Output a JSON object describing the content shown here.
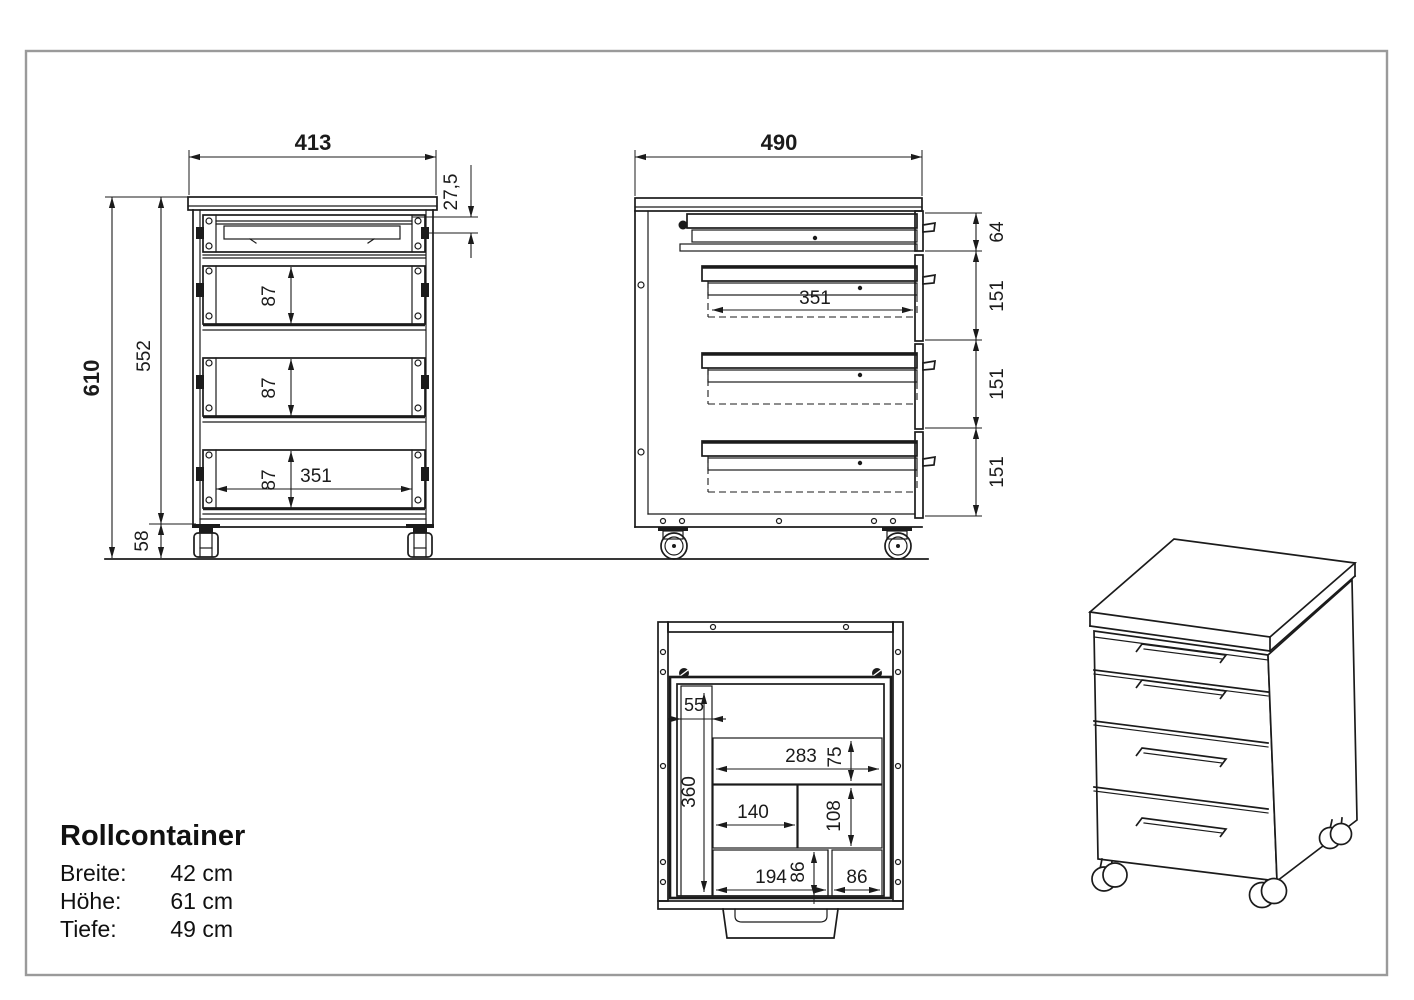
{
  "page": {
    "background": "#ffffff",
    "border_color": "#9a9a9a",
    "line_color": "#1b1b1b"
  },
  "title_block": {
    "title": "Rollcontainer",
    "rows": [
      {
        "label": "Breite:",
        "value": "42 cm"
      },
      {
        "label": "Höhe:",
        "value": "61 cm"
      },
      {
        "label": "Tiefe:",
        "value": "49 cm"
      }
    ]
  },
  "front_view": {
    "dims": {
      "width": "413",
      "tray_offset": "27,5",
      "total_height": "610",
      "body_height": "552",
      "caster_height": "58",
      "drawer2_height": "87",
      "drawer3_height": "87",
      "drawer4_height": "87",
      "inner_width": "351"
    }
  },
  "side_view": {
    "dims": {
      "depth": "490",
      "front1_height": "64",
      "front2_height": "151",
      "front3_height": "151",
      "front4_height": "151",
      "drawer_depth": "351"
    }
  },
  "bottom_view": {
    "dims": {
      "slot_width": "55",
      "slot_depth": "360",
      "comp1_width": "283",
      "comp1_depth": "75",
      "comp2_width": "140",
      "comp2_depth": "108",
      "comp3_width": "194",
      "comp3_height": "86",
      "comp4_width": "86"
    }
  }
}
